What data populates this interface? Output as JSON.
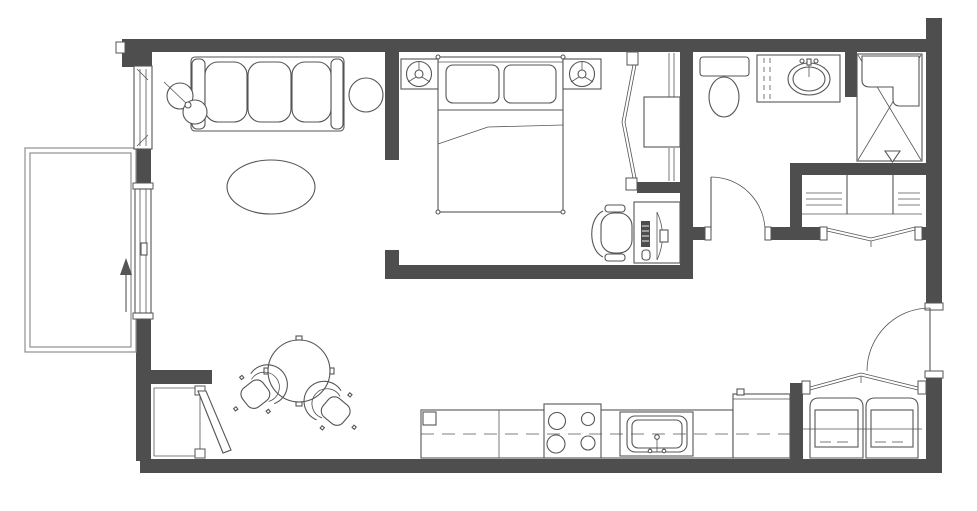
{
  "meta": {
    "title": "Studio apartment floor plan",
    "drawing_type": "architectural floor plan, top view line drawing",
    "orientation_arrow": "up"
  },
  "colors": {
    "bg": "#ffffff",
    "wall": "#4e4e4e",
    "line": "#555555",
    "line-light": "#8f8f8f"
  },
  "rooms": [
    {
      "id": "balcony",
      "label": "Balcony",
      "features": [
        "guard-rail",
        "sliding-glass-door",
        "direction-arrow"
      ]
    },
    {
      "id": "living-room",
      "label": "Living room",
      "furniture": [
        "three-seat-sofa",
        "floor-lamp",
        "round-side-table",
        "oval-coffee-table"
      ]
    },
    {
      "id": "dining-area",
      "label": "Dining area",
      "furniture": [
        "round-dining-table",
        "tub-chair-left",
        "tub-chair-right"
      ]
    },
    {
      "id": "storage-closet",
      "label": "Storage closet",
      "features": [
        "hinged-door-ajar"
      ]
    },
    {
      "id": "bedroom",
      "label": "Bedroom",
      "furniture": [
        "double-bed",
        "two-pillows",
        "nightstand-left",
        "nightstand-right",
        "two-table-lamps",
        "desk",
        "monitor",
        "keyboard",
        "office-chair"
      ]
    },
    {
      "id": "bedroom-closet",
      "label": "Wardrobe closet",
      "features": [
        "bifold-door",
        "shelf-box",
        "hanging-rod"
      ]
    },
    {
      "id": "bathroom",
      "label": "Bathroom",
      "fixtures": [
        "toilet",
        "vanity-counter",
        "oval-sink",
        "shower-with-seat",
        "floor-drain",
        "hinged-door"
      ]
    },
    {
      "id": "linen-closet",
      "label": "Linen closet",
      "features": [
        "shelving-bays",
        "bifold-doors"
      ]
    },
    {
      "id": "kitchen",
      "label": "Kitchen",
      "fixtures": [
        "base-counter",
        "upper-cabinet-dashed-line",
        "four-burner-cooktop",
        "kitchen-sink",
        "refrigerator"
      ]
    },
    {
      "id": "laundry-closet",
      "label": "Laundry closet",
      "fixtures": [
        "washer",
        "dryer",
        "bifold-doors",
        "shelf-rod"
      ]
    },
    {
      "id": "entry",
      "label": "Entry",
      "features": [
        "entry-door-swing"
      ]
    }
  ],
  "doors": [
    {
      "id": "entry-door",
      "type": "hinged"
    },
    {
      "id": "bathroom-door",
      "type": "hinged"
    },
    {
      "id": "balcony-door",
      "type": "sliding"
    },
    {
      "id": "bedroom-closet-door",
      "type": "bifold"
    },
    {
      "id": "linen-closet-door",
      "type": "bifold"
    },
    {
      "id": "laundry-closet-door",
      "type": "bifold"
    },
    {
      "id": "storage-closet-door",
      "type": "hinged"
    }
  ],
  "windows": [
    {
      "id": "living-room-window",
      "wall": "left"
    }
  ]
}
